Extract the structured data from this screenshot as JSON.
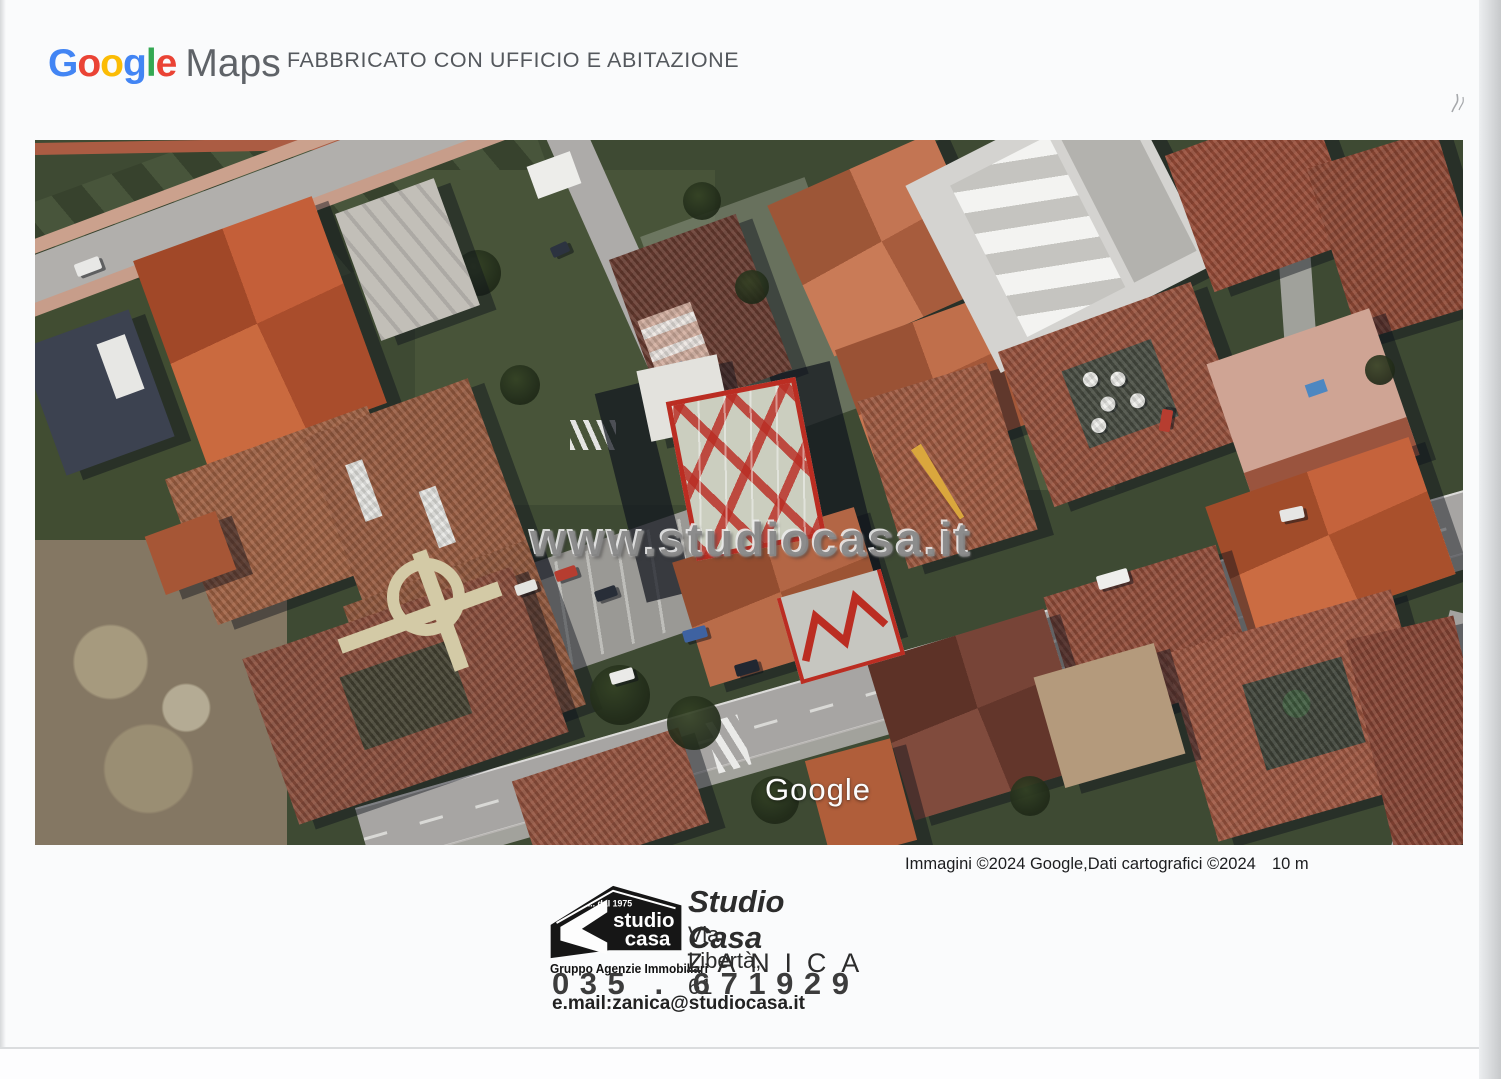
{
  "header": {
    "logo": {
      "letters": [
        {
          "char": "G",
          "color": "#4285F4"
        },
        {
          "char": "o",
          "color": "#EA4335"
        },
        {
          "char": "o",
          "color": "#FBBC05"
        },
        {
          "char": "g",
          "color": "#4285F4"
        },
        {
          "char": "l",
          "color": "#34A853"
        },
        {
          "char": "e",
          "color": "#EA4335"
        }
      ],
      "maps": "Maps"
    },
    "title": "FABBRICATO CON UFFICIO E ABITAZIONE"
  },
  "map": {
    "watermark": "www.studiocasa.it",
    "google_watermark": "Google",
    "highlight_color": "#c6291d"
  },
  "attribution": {
    "text": "Immagini ©2024 Google,Dati cartografici ©2024",
    "scale": "10 m"
  },
  "stamp": {
    "logo": {
      "tagline": "... dal 1975",
      "word1": "studio",
      "word2": "casa",
      "subtitle": "Gruppo Agenzie Immobiliari"
    },
    "company": "Studio Casa",
    "address": "Via Libertà, 61",
    "city": "ZANICA",
    "phone": "035 . 671929",
    "email": "e.mail:zanica@studiocasa.it"
  }
}
